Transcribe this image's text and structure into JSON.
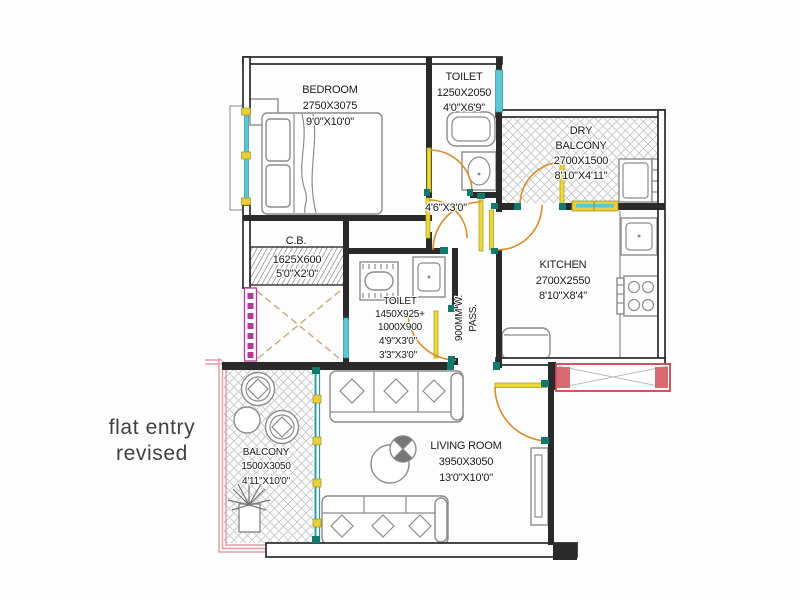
{
  "annotation": {
    "line1": "flat entry",
    "line2": "revised"
  },
  "rooms": {
    "bedroom": {
      "name": "BEDROOM",
      "dim_mm": "2750X3075",
      "dim_ft": "9'0\"X10'0\""
    },
    "toilet1": {
      "name": "TOILET",
      "dim_mm": "1250X2050",
      "dim_ft": "4'0\"X6'9\""
    },
    "dry_balcony": {
      "name_line1": "DRY",
      "name_line2": "BALCONY",
      "dim_mm": "2700X1500",
      "dim_ft": "8'10\"X4'11\""
    },
    "kitchen": {
      "name": "KITCHEN",
      "dim_mm": "2700X2550",
      "dim_ft": "8'10\"X8'4\""
    },
    "cupboard": {
      "name": "C.B.",
      "dim_mm": "1625X600",
      "dim_ft": "5'0\"X2'0\""
    },
    "toilet2": {
      "name": "TOILET",
      "dim_mm_1": "1450X925+",
      "dim_mm_2": "1000X900",
      "dim_ft_1": "4'9\"X3'0\"",
      "dim_ft_2": "3'3\"X3'0\""
    },
    "lobby": {
      "dim_ft": "4'6\"X3'0\""
    },
    "passage": {
      "label_line1": "900MM W.",
      "label_line2": "PASS."
    },
    "living_room": {
      "name": "LIVING ROOM",
      "dim_mm": "3950X3050",
      "dim_ft": "13'0\"X10'0\""
    },
    "balcony": {
      "name": "BALCONY",
      "dim_mm": "1500X3050",
      "dim_ft": "4'11\"X10'0\""
    }
  },
  "colors": {
    "wall": "#2a2a2a",
    "door_panel": "#ead83c",
    "door_swing_arc": "#d98c2b",
    "door_frame_cap": "#0f7a6d",
    "window_glass": "#5bc6d4",
    "window_frame": "#e8cf3a",
    "louver_vent": "#b23aa0",
    "balcony_railing": "#e0a0a6",
    "entry_grill": "#cc4452",
    "furniture": "#8c8c8c",
    "hatch": "#c6c6c6",
    "text": "#1b1b1b"
  }
}
